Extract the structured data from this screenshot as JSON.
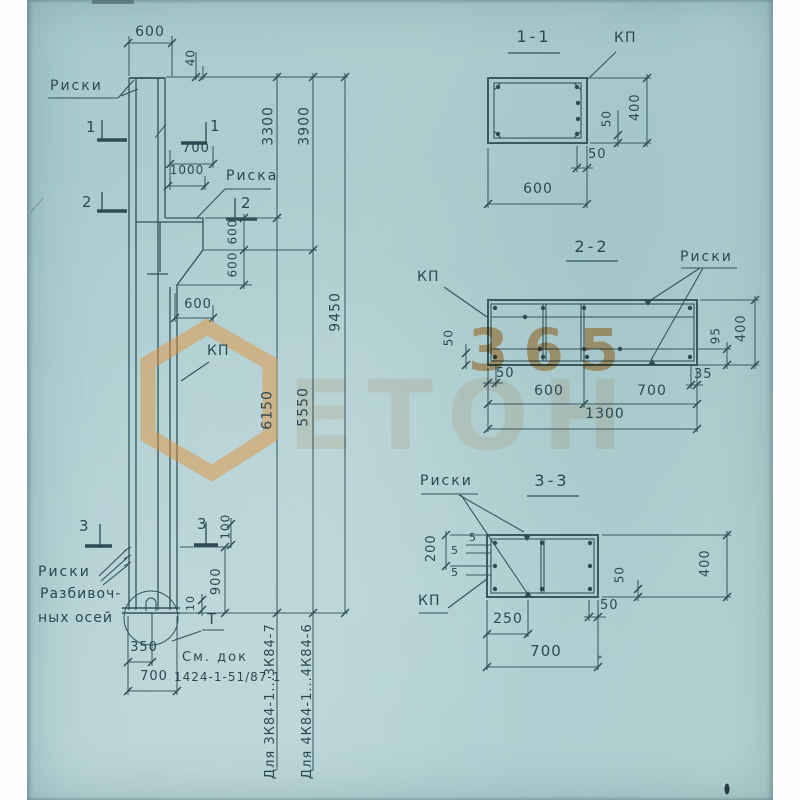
{
  "watermark": {
    "digits": "365",
    "word": "ЕТОН"
  },
  "left_view": {
    "labels": {
      "riski_top": "Риски",
      "riska": "Риска",
      "kp": "КП",
      "riski_axes_1": "Риски",
      "riski_axes_2": "Разбивоч-",
      "riski_axes_3": "ных осей",
      "doc_note_1": "См. док",
      "doc_note_2": "1424-1-51/87-1",
      "t_mark": "Т",
      "for_3k84": "Для 3К84-1...3К84-7",
      "for_4k84": "Для 4К84-1...4К84-6"
    },
    "markers": {
      "s1a": "1",
      "s1b": "1",
      "s2a": "2",
      "s2b": "2",
      "s3a": "3",
      "s3b": "3"
    },
    "dims": {
      "top_600": "600",
      "top_40": "40",
      "w_700": "700",
      "w_1000": "1000",
      "corbel_600a": "600",
      "corbel_600b": "600",
      "corbel_600c": "600",
      "v_3300": "3300",
      "v_3900": "3900",
      "v_6150": "6150",
      "v_5550": "5550",
      "v_9450": "9450",
      "v_100": "100",
      "v_900": "900",
      "v_10": "10",
      "b_350": "350",
      "b_700": "700"
    }
  },
  "section_1_1": {
    "title": "1-1",
    "kp": "КП",
    "dims": {
      "h_400": "400",
      "in_50": "50",
      "b_50": "50",
      "w_600": "600"
    }
  },
  "section_2_2": {
    "title": "2-2",
    "kp": "КП",
    "riski": "Риски",
    "dims": {
      "l_50": "50",
      "b_50": "50",
      "w_600": "600",
      "w_700": "700",
      "b_35": "35",
      "total_1300": "1300",
      "r_95": "95",
      "h_400": "400"
    }
  },
  "section_3_3": {
    "title": "3-3",
    "riski": "Риски",
    "kp": "КП",
    "dims": {
      "l_200": "200",
      "o5a": "5",
      "o5b": "5",
      "o5c": "5",
      "r_50": "50",
      "h_400": "400",
      "b_50": "50",
      "b_250": "250",
      "w_700": "700"
    }
  }
}
